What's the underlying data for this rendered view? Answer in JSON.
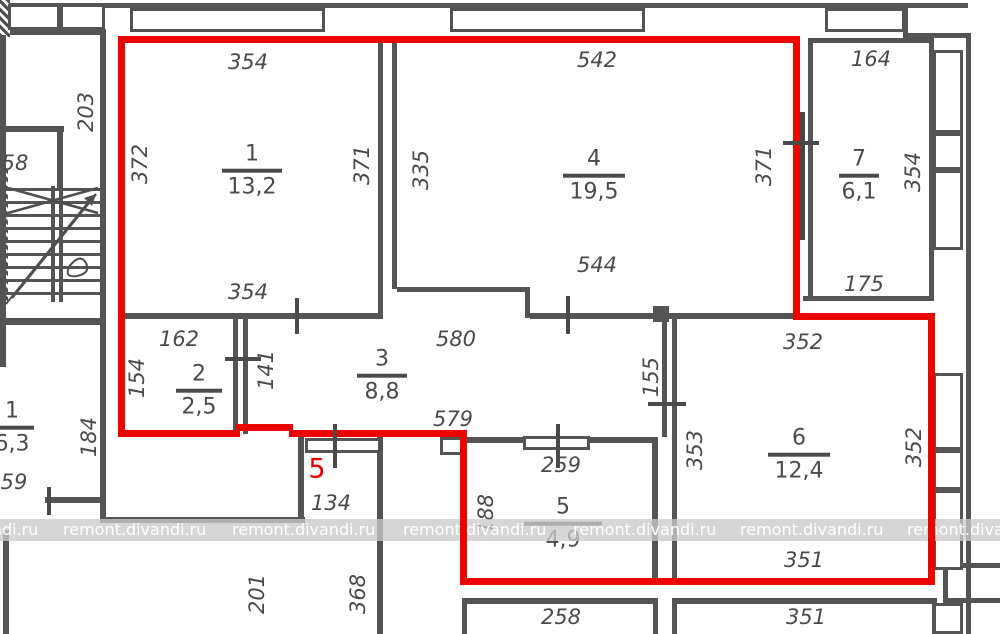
{
  "watermark": {
    "text": "remont.divandi.ru"
  },
  "flat_number": "5",
  "colors": {
    "outline_red": "#ec0400",
    "wall_gray": "#545454",
    "label_gray": "#4a4a4a",
    "watermark_band": "#cbcbcb"
  },
  "rooms": [
    {
      "number": "1",
      "area": "13,2"
    },
    {
      "number": "2",
      "area": "2,5"
    },
    {
      "number": "3",
      "area": "8,8"
    },
    {
      "number": "4",
      "area": "19,5"
    },
    {
      "number": "5",
      "area": "4,9"
    },
    {
      "number": "6",
      "area": "12,4"
    },
    {
      "number": "7",
      "area": "6,1"
    }
  ],
  "neighbor_room": {
    "number": "1",
    "area": "6,3"
  },
  "dimensions": {
    "stair_58": "58",
    "stair_203": "203",
    "r1_top": "354",
    "r1_left": "372",
    "r1_right": "371",
    "r1_bottom": "354",
    "r4_top": "542",
    "r4_left": "335",
    "r4_right": "371",
    "r4_bottom": "544",
    "r7_top": "164",
    "r7_right": "354",
    "r7_bottom": "175",
    "r2_top": "162",
    "r2_left": "154",
    "r2_right": "141",
    "r3_top": "580",
    "r3_bottom": "579",
    "r3_right": "155",
    "r5_top": "259",
    "r5_left": "188",
    "r6_top": "352",
    "r6_left": "353",
    "r6_right": "352",
    "r6_bottom": "351",
    "entry_width": "134",
    "below_left": "201",
    "below_right": "368",
    "bottom_left_room": "258",
    "bottom_right_room": "351",
    "left_flat_height": "184",
    "left_flat_small": "59"
  }
}
